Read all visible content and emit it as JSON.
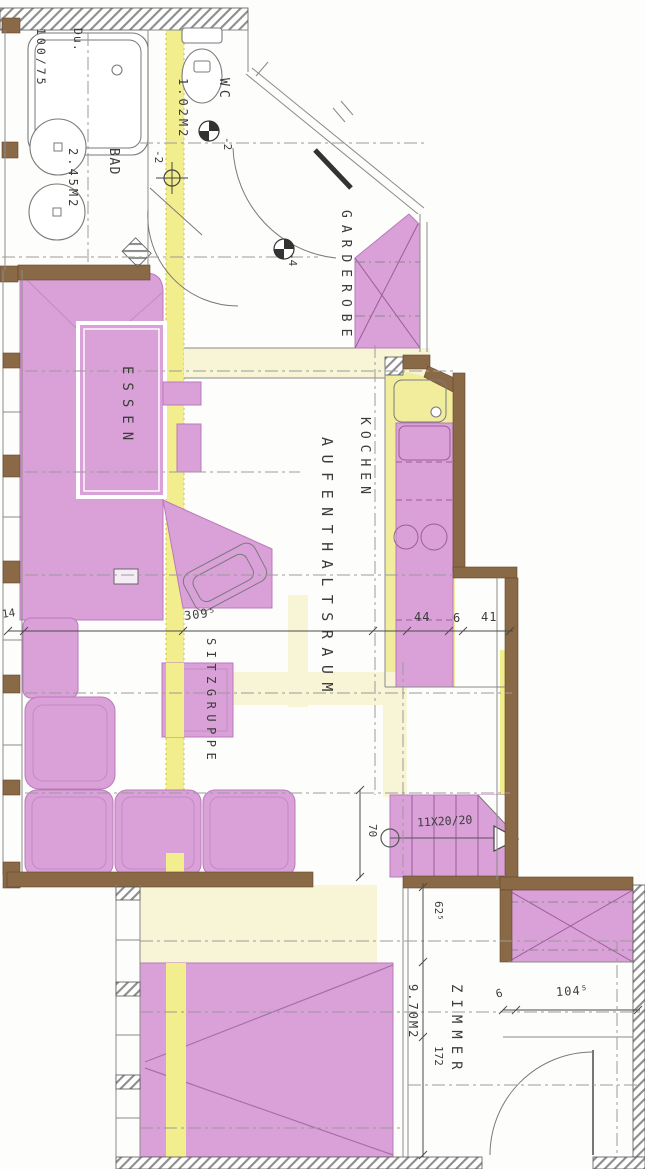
{
  "plan": {
    "rooms": {
      "shower": {
        "name": "Du.",
        "size": "100/75"
      },
      "wc": {
        "name": "WC",
        "area": "1.02M2"
      },
      "bath": {
        "name": "BAD",
        "area": "2.45M2"
      },
      "garderobe": {
        "name": "GARDEROBE"
      },
      "dining": {
        "name": "ESSEN"
      },
      "kitchen": {
        "name": "KOCHEN"
      },
      "living": {
        "name": "AUFENTHALTSRAUM"
      },
      "seating": {
        "name": "SITZGRUPPE"
      },
      "room": {
        "name": "ZIMMER",
        "area": "9.70M2"
      }
    },
    "dimensions": {
      "wall_14": "14",
      "living_width": "309⁵",
      "seg_44": "44",
      "seg_6": "6",
      "seg_41": "41",
      "stair_width": "70",
      "stair_steps": "11X20/20",
      "niche_62": "62⁵",
      "room_172": "172",
      "room_seg_6": "6",
      "room_width": "104⁵"
    },
    "levels": {
      "hall": "-2",
      "wc": "-2",
      "entry": "-4"
    },
    "colors": {
      "furniture": "#d9a1d8",
      "circulation": "#f2ee8e",
      "circulation_pale": "#f8f5d6",
      "wall": "#8a6947"
    }
  }
}
